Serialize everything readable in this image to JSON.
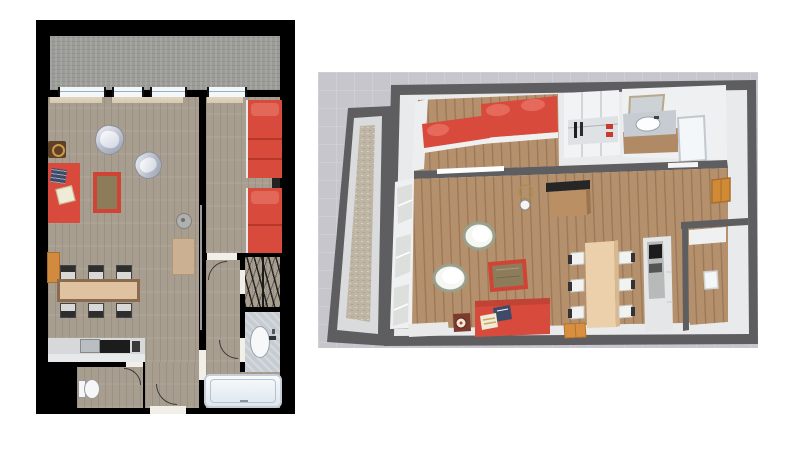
{
  "scene": {
    "description": "Two views of the same apartment: a 2D top-down floor plan (left) and a 3D aerial dollhouse view (right). No text labels are rendered.",
    "views": [
      {
        "id": "floor-plan-2d",
        "type": "2d-floor-plan",
        "rooms": [
          "terrace",
          "living-room",
          "dining-area",
          "kitchen",
          "wc",
          "hallway",
          "bedroom",
          "closet",
          "bathroom"
        ],
        "window_count": 4,
        "furniture": [
          "red-sofa",
          "navy-pillow",
          "white-pillow",
          "side-table",
          "red-bordered-rug",
          "silver-armchair",
          "silver-armchair",
          "dining-table",
          "dining-chairs",
          "orange-cabinet",
          "kitchen-counter",
          "stove",
          "sink",
          "toilet",
          "desk",
          "ceiling-lamp",
          "red-bed",
          "red-bed",
          "nightstand",
          "wardrobe-hangers",
          "vanity-sink",
          "bathtub",
          "entry-door"
        ],
        "dining_chair_count": 6,
        "bed_count": 2
      },
      {
        "id": "floor-plan-3d",
        "type": "3d-dollhouse-view",
        "rooms": [
          "terrace",
          "bedroom",
          "closet",
          "bathroom",
          "living-room",
          "dining-area",
          "kitchen",
          "wc"
        ],
        "furniture": [
          "red-bed",
          "red-bed",
          "wardrobe",
          "vanity-sink",
          "mirror",
          "bathtub",
          "tv-panel",
          "desk",
          "chandelier",
          "white-armchair",
          "white-armchair",
          "red-rug",
          "red-sofa",
          "navy-pillow",
          "striped-pillow",
          "barrel-stool",
          "dining-table",
          "dining-chairs",
          "orange-boxes",
          "kitchen-column",
          "wall-cabinet",
          "toilet"
        ],
        "dining_chair_count": 6,
        "bed_count": 2
      }
    ]
  },
  "colors": {
    "page-bg": "#ffffff",
    "wall2d": "#000000",
    "wood2d": "#a89e90",
    "terrace2d": "#9b9b97",
    "winblue": "#8fb6c6",
    "red": "#d84b3c",
    "reddark": "#b93a2e",
    "rugc": "#8d7c5a",
    "rugb": "#cf4435",
    "silver": "#c7cbd4",
    "tabletan": "#dfc2a0",
    "tableedge": "#8a6b4e",
    "orange": "#d28a3e",
    "counter": "#d7d8da",
    "appliance": "#1c1c1c",
    "marble": "#c6ccd2",
    "tub": "#eef1f6",
    "browntbl": "#5f4026",
    "bg3d": "#c7c6cc",
    "wall3d": "#5e5d5f",
    "innerwall3d": "#e9eaec",
    "wood3d": "#b5906d",
    "terrace3d": "#beb5a5",
    "tan3d": "#ecd0ac",
    "navy": "#3d4a68",
    "cream": "#f0ead8",
    "curtain": "#dbceb6",
    "desk2d": "#cbb091"
  }
}
